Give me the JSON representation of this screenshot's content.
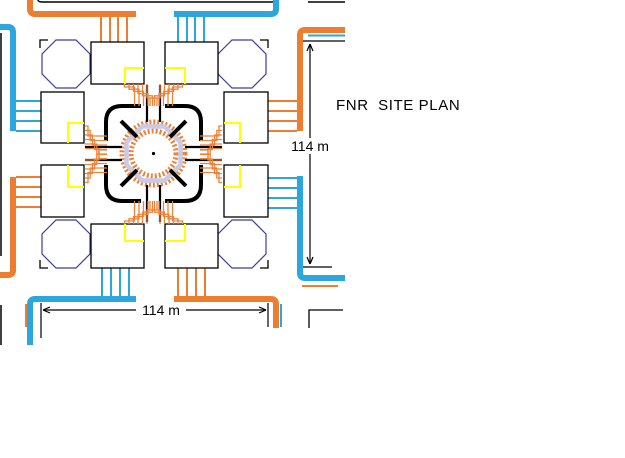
{
  "title": "FNR  SITE PLAN",
  "dimensions": {
    "vertical_label": "114 m",
    "horizontal_label": "114 m"
  },
  "colors": {
    "road_orange": "#ED7D31",
    "road_blue": "#2BA7DE",
    "hatch_orange": "#EE8239",
    "yellow": "#FFFF00",
    "navy": "#3B3BA8",
    "lavender": "#C9C9E8",
    "black": "#000000",
    "white": "#FFFFFF"
  },
  "diagram": {
    "width": 625,
    "height": 458,
    "layers": [
      {
        "name": "clip-edge-lines",
        "kind": "paths",
        "items": [
          {
            "n": "top-road-line",
            "d": "M 38 0 Q 38 2 43 2 L 271 2 Q 276 2 276 0",
            "c": "black",
            "w": 1.5
          },
          {
            "n": "top-road-line-right",
            "d": "M 308 2 L 345 2",
            "c": "black",
            "w": 1.5
          },
          {
            "n": "left-clip-line-upper",
            "d": "M 1 33 L 1 256",
            "c": "black",
            "w": 1.5
          },
          {
            "n": "left-clip-line-lower",
            "d": "M 1 305 L 1 345",
            "c": "black",
            "w": 1.5
          },
          {
            "n": "adjacent-site-corner",
            "d": "M 309 328 L 309 310 L 343 310",
            "c": "black",
            "w": 1.3
          }
        ]
      },
      {
        "name": "roads",
        "kind": "paths",
        "items": [
          {
            "n": "road-orange-top-left",
            "d": "M 30 0 L 30 9 Q 30 14 35 14 L 136 14",
            "c": "orange",
            "w": 6
          },
          {
            "n": "road-blue-top-right",
            "d": "M 174 14 L 271 14 Q 276 14 276 9 L 276 0",
            "c": "blue",
            "w": 6
          },
          {
            "n": "road-blue-left-upper",
            "d": "M 0 27 L 8 27 Q 13 27 13 32 L 13 131",
            "c": "blue",
            "w": 6
          },
          {
            "n": "road-orange-left-lower",
            "d": "M 13 177 L 13 270 Q 13 275 8 275 L 0 275",
            "c": "orange",
            "w": 6
          },
          {
            "n": "road-orange-right-upper",
            "d": "M 345 30 L 305 30 Q 300 30 300 35 L 300 131",
            "c": "orange",
            "w": 6
          },
          {
            "n": "road-blue-right-lower",
            "d": "M 300 176 L 300 273 Q 300 278 305 278 L 345 278",
            "c": "blue",
            "w": 6
          },
          {
            "n": "road-blue-bottom-left",
            "d": "M 136 299 L 35 299 Q 30 299 30 304 L 30 345",
            "c": "blue",
            "w": 6
          },
          {
            "n": "road-orange-bottom-right",
            "d": "M 174 299 L 271 299 Q 276 299 276 304 L 276 328",
            "c": "orange",
            "w": 6
          },
          {
            "n": "service-line-orange-bottom-left",
            "d": "M 26 304 L 26 327",
            "c": "orange",
            "w": 2
          },
          {
            "n": "service-line-blue-bottom-right",
            "d": "M 281 304 L 281 327",
            "c": "blue",
            "w": 2
          },
          {
            "n": "service-line-blue-top-right",
            "d": "M 308 35.5 L 345 35.5",
            "c": "blue",
            "w": 2
          },
          {
            "n": "service-line-orange-right",
            "d": "M 302 286 L 338 286",
            "c": "orange",
            "w": 2
          }
        ]
      },
      {
        "name": "feeder-lines",
        "kind": "lines",
        "items": [
          {
            "n": "feeders-top-left-orange",
            "axis": "v",
            "at": [
              101,
              110,
              118,
              127
            ],
            "from": 16,
            "to": 42,
            "c": "orange",
            "w": 2
          },
          {
            "n": "feeders-top-right-blue",
            "axis": "v",
            "at": [
              178,
              187,
              195,
              204
            ],
            "from": 16,
            "to": 42,
            "c": "blue",
            "w": 2
          },
          {
            "n": "feeders-left-upper-blue",
            "axis": "h",
            "at": [
              101,
              111,
              121,
              131
            ],
            "from": 16,
            "to": 41,
            "c": "blue",
            "w": 2
          },
          {
            "n": "feeders-left-lower-orange",
            "axis": "h",
            "at": [
              177,
              187,
              197,
              207
            ],
            "from": 16,
            "to": 41,
            "c": "orange",
            "w": 2
          },
          {
            "n": "feeders-right-upper-orange",
            "axis": "h",
            "at": [
              101,
              111,
              121,
              131
            ],
            "from": 268,
            "to": 297,
            "c": "orange",
            "w": 2
          },
          {
            "n": "feeders-right-lower-blue",
            "axis": "h",
            "at": [
              178,
              188,
              198,
              208
            ],
            "from": 268,
            "to": 297,
            "c": "blue",
            "w": 2
          },
          {
            "n": "feeders-bottom-left-blue",
            "axis": "v",
            "at": [
              102,
              111,
              120,
              129
            ],
            "from": 268,
            "to": 296,
            "c": "blue",
            "w": 2
          },
          {
            "n": "feeders-bottom-right-orange",
            "axis": "v",
            "at": [
              178,
              187,
              196,
              205
            ],
            "from": 268,
            "to": 296,
            "c": "orange",
            "w": 2
          }
        ]
      },
      {
        "name": "site-boundary-corners",
        "kind": "paths",
        "items": [
          {
            "n": "boundary-corner-top-left",
            "d": "M 40 48 L 40 40 L 48 40",
            "c": "black",
            "w": 1.3
          },
          {
            "n": "boundary-corner-top-right",
            "d": "M 260 40 L 268 40 L 268 48",
            "c": "black",
            "w": 1.3
          },
          {
            "n": "boundary-corner-bottom-left",
            "d": "M 40 260 L 40 268 L 48 268",
            "c": "black",
            "w": 1.3
          },
          {
            "n": "boundary-corner-bottom-right",
            "d": "M 268 260 L 268 268 L 260 268",
            "c": "black",
            "w": 1.3
          }
        ]
      },
      {
        "name": "octagon-buildings",
        "kind": "polys",
        "items": [
          {
            "n": "octagon-building-top-left",
            "points": "56,40 76,40 90,54 90,74 76,88 56,88 42,74 42,54",
            "c": "navy",
            "w": 1.2
          },
          {
            "n": "octagon-building-top-right",
            "points": "232,40 252,40 266,54 266,74 252,88 232,88 218,74 218,54",
            "c": "navy",
            "w": 1.2
          },
          {
            "n": "octagon-building-bottom-left",
            "points": "56,220 76,220 90,234 90,254 76,268 56,268 42,254 42,234",
            "c": "navy",
            "w": 1.2
          },
          {
            "n": "octagon-building-bottom-right",
            "points": "232,220 252,220 266,234 266,254 252,268 232,268 218,254 218,234",
            "c": "navy",
            "w": 1.2
          }
        ]
      },
      {
        "name": "rect-buildings",
        "kind": "rects",
        "items": [
          {
            "n": "building-top-left",
            "x": 91,
            "y": 42,
            "w": 53,
            "h": 42
          },
          {
            "n": "building-top-right",
            "x": 165,
            "y": 42,
            "w": 53,
            "h": 42
          },
          {
            "n": "building-bottom-left",
            "x": 91,
            "y": 224,
            "w": 53,
            "h": 44
          },
          {
            "n": "building-bottom-right",
            "x": 165,
            "y": 224,
            "w": 53,
            "h": 44
          },
          {
            "n": "building-left-upper",
            "x": 41,
            "y": 92,
            "w": 43,
            "h": 51
          },
          {
            "n": "building-left-lower",
            "x": 41,
            "y": 165,
            "w": 43,
            "h": 52
          },
          {
            "n": "building-right-upper",
            "x": 224,
            "y": 92,
            "w": 44,
            "h": 51
          },
          {
            "n": "building-right-lower",
            "x": 224,
            "y": 165,
            "w": 44,
            "h": 52
          }
        ]
      },
      {
        "name": "yellow-utility-marks",
        "kind": "paths",
        "items": [
          {
            "n": "yellow-mark-top-left",
            "d": "M 125 84 L 125 68 L 144 68",
            "c": "yellow",
            "w": 2
          },
          {
            "n": "yellow-mark-top-right",
            "d": "M 165 68 L 185 68 L 185 84",
            "c": "yellow",
            "w": 2
          },
          {
            "n": "yellow-mark-bottom-left",
            "d": "M 125 224 L 125 241 L 144 241",
            "c": "yellow",
            "w": 2
          },
          {
            "n": "yellow-mark-bottom-right",
            "d": "M 165 241 L 185 241 L 185 224",
            "c": "yellow",
            "w": 2
          },
          {
            "n": "yellow-mark-left-upper",
            "d": "M 84 123 L 68 123 L 68 143",
            "c": "yellow",
            "w": 2
          },
          {
            "n": "yellow-mark-left-lower",
            "d": "M 84 187 L 68 187 L 68 165",
            "c": "yellow",
            "w": 2
          },
          {
            "n": "yellow-mark-right-upper",
            "d": "M 224 123 L 240 123 L 240 143",
            "c": "yellow",
            "w": 2
          },
          {
            "n": "yellow-mark-right-lower",
            "d": "M 224 187 L 240 187 L 240 165",
            "c": "yellow",
            "w": 2
          }
        ]
      },
      {
        "name": "core-hatch-outer",
        "kind": "circles",
        "items": [
          {
            "n": "hatch-ring-outer",
            "cx": 153.5,
            "cy": 153.5,
            "r": 31.5,
            "c": "hatch",
            "w": 5,
            "dash": "2 2"
          },
          {
            "n": "hatch-ring-inner",
            "cx": 153.5,
            "cy": 153.5,
            "r": 22.5,
            "c": "hatch",
            "w": 5,
            "dash": "2 2"
          }
        ]
      },
      {
        "name": "core-octagon-ring",
        "kind": "polys",
        "items": [
          {
            "n": "core-lavender-ring",
            "points": "142.3,126.5 164.7,126.5 180.5,142.3 180.5,164.7 164.7,180.5 142.3,180.5 126.5,164.7 126.5,142.3",
            "c": "lavender",
            "w": 4.5
          }
        ]
      },
      {
        "name": "core-interior",
        "kind": "circles",
        "items": [
          {
            "n": "core-white-interior",
            "cx": 153.5,
            "cy": 153.5,
            "r": 18.5,
            "fill": "#FFFFFF"
          },
          {
            "n": "core-center-dot",
            "cx": 153.5,
            "cy": 153.5,
            "r": 1.6,
            "fill": "#000000"
          }
        ]
      },
      {
        "name": "core-structure",
        "kind": "paths",
        "items": [
          {
            "n": "core-wall-top-left",
            "d": "M 141 106 L 122 106 Q 106 106 106 122 L 106 141",
            "c": "black",
            "w": 4
          },
          {
            "n": "core-wall-top-right",
            "d": "M 165 106 L 185 106 Q 201 106 201 122 L 201 141",
            "c": "black",
            "w": 4
          },
          {
            "n": "core-wall-bottom-right",
            "d": "M 201 165 L 201 185 Q 201 201 185 201 L 165 201",
            "c": "black",
            "w": 4
          },
          {
            "n": "core-wall-bottom-left",
            "d": "M 141 201 L 122 201 Q 106 201 106 185 L 106 165",
            "c": "black",
            "w": 4
          },
          {
            "n": "core-diagonal-top-left",
            "d": "M 121 121 L 137 137",
            "c": "black",
            "w": 4
          },
          {
            "n": "core-diagonal-top-right",
            "d": "M 186 121 L 170 137",
            "c": "black",
            "w": 4
          },
          {
            "n": "core-diagonal-bottom-right",
            "d": "M 186 186 L 170 170",
            "c": "black",
            "w": 4
          },
          {
            "n": "core-diagonal-bottom-left",
            "d": "M 121 186 L 137 170",
            "c": "black",
            "w": 4
          },
          {
            "n": "core-channel-top-a",
            "d": "M 147 85 L 147 122",
            "c": "black",
            "w": 2.2
          },
          {
            "n": "core-channel-top-b",
            "d": "M 160 85 L 160 122",
            "c": "black",
            "w": 2.2
          },
          {
            "n": "core-channel-bottom-a",
            "d": "M 147 222 L 147 185",
            "c": "black",
            "w": 2.2
          },
          {
            "n": "core-channel-bottom-b",
            "d": "M 160 222 L 160 185",
            "c": "black",
            "w": 2.2
          },
          {
            "n": "core-channel-left-a",
            "d": "M 85 147 L 122 147",
            "c": "black",
            "w": 2.2
          },
          {
            "n": "core-channel-left-b",
            "d": "M 85 160 L 122 160",
            "c": "black",
            "w": 2.2
          },
          {
            "n": "core-channel-right-a",
            "d": "M 222 147 L 185 147",
            "c": "black",
            "w": 2.2
          },
          {
            "n": "core-channel-right-b",
            "d": "M 222 160 L 185 160",
            "c": "black",
            "w": 2.2
          }
        ]
      },
      {
        "name": "pipe-bundles",
        "kind": "bundles",
        "items": [
          {
            "n": 6,
            "axis": "v",
            "a": 84,
            "b": 106,
            "p0": 124.5,
            "gap": 4.5,
            "shift": 10,
            "m0": 87,
            "stag": 2.2,
            "rev": false,
            "c": "hatch",
            "w": 1.3
          },
          {
            "n": 6,
            "axis": "v",
            "a": 84,
            "b": 106,
            "p0": 160,
            "gap": 4.5,
            "shift": -10,
            "m0": 87,
            "stag": 2.2,
            "rev": true,
            "c": "hatch",
            "w": 1.3
          },
          {
            "n": 6,
            "axis": "v",
            "a": 224,
            "b": 201,
            "p0": 124.5,
            "gap": 4.5,
            "shift": 10,
            "m0": 221,
            "stag": -2.2,
            "rev": false,
            "c": "hatch",
            "w": 1.3
          },
          {
            "n": 6,
            "axis": "v",
            "a": 224,
            "b": 201,
            "p0": 160,
            "gap": 4.5,
            "shift": -10,
            "m0": 221,
            "stag": -2.2,
            "rev": true,
            "c": "hatch",
            "w": 1.3
          },
          {
            "n": 6,
            "axis": "h",
            "a": 85,
            "b": 107,
            "p0": 126,
            "gap": 4.5,
            "shift": 10,
            "m0": 88,
            "stag": 2.2,
            "rev": false,
            "c": "hatch",
            "w": 1.3
          },
          {
            "n": 6,
            "axis": "h",
            "a": 85,
            "b": 107,
            "p0": 160,
            "gap": 4.5,
            "shift": -10,
            "m0": 88,
            "stag": 2.2,
            "rev": true,
            "c": "hatch",
            "w": 1.3
          },
          {
            "n": 6,
            "axis": "h",
            "a": 222,
            "b": 200,
            "p0": 126,
            "gap": 4.5,
            "shift": 10,
            "m0": 219,
            "stag": -2.2,
            "rev": false,
            "c": "hatch",
            "w": 1.3
          },
          {
            "n": 6,
            "axis": "h",
            "a": 222,
            "b": 200,
            "p0": 160,
            "gap": 4.5,
            "shift": -10,
            "m0": 219,
            "stag": -2.2,
            "rev": true,
            "c": "hatch",
            "w": 1.3
          }
        ]
      },
      {
        "name": "dimension-lines",
        "kind": "paths",
        "items": [
          {
            "n": "dim-vertical-line",
            "d": "M 310 44 L 310 264",
            "c": "black",
            "w": 1.2
          },
          {
            "n": "dim-vertical-arrowheads",
            "d": "M 310 44 L 307 51 M 310 44 L 313 51 M 310 264 L 307 257 M 310 264 L 313 257",
            "c": "black",
            "w": 1.2
          },
          {
            "n": "dim-vertical-ext-top",
            "d": "M 303 41 L 345 41",
            "c": "black",
            "w": 1.2
          },
          {
            "n": "dim-vertical-ext-bottom",
            "d": "M 303 267 L 332 267",
            "c": "black",
            "w": 1.2
          },
          {
            "n": "dim-horizontal-line",
            "d": "M 43 310 L 266 310",
            "c": "black",
            "w": 1.2
          },
          {
            "n": "dim-horizontal-arrowheads",
            "d": "M 43 310 L 50 307 M 43 310 L 50 313 M 266 310 L 259 307 M 266 310 L 259 313",
            "c": "black",
            "w": 1.2
          },
          {
            "n": "dim-horizontal-ext-left",
            "d": "M 41 303 L 41 338",
            "c": "black",
            "w": 1.2
          },
          {
            "n": "dim-horizontal-ext-right",
            "d": "M 268 303 L 268 327",
            "c": "black",
            "w": 1.2
          }
        ]
      }
    ]
  }
}
